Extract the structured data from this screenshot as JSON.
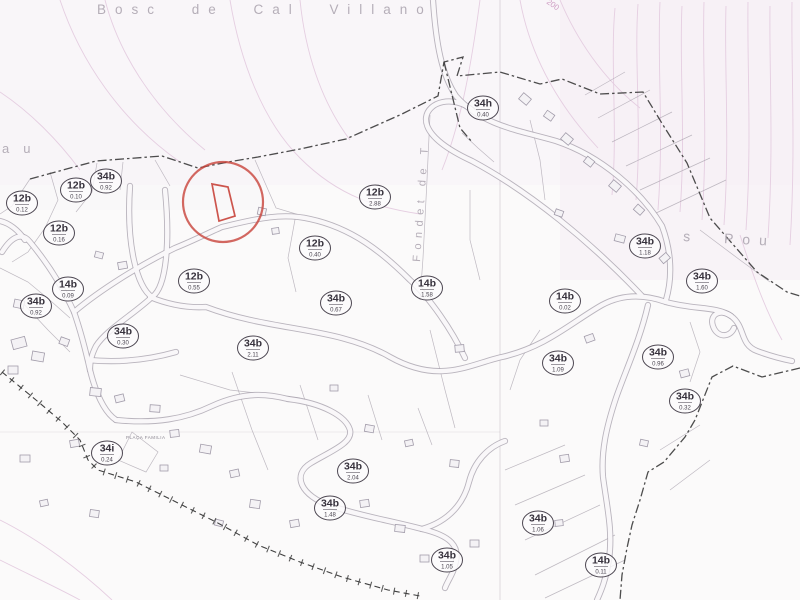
{
  "map": {
    "place_labels": {
      "top": "Bosc de Cal Villano",
      "left_edge": "au",
      "right_edge": "s  Pou",
      "street_vertical": "Fondet de T",
      "contour_elevation": "200",
      "plaza": "PLAÇA FAMILIA"
    },
    "colors": {
      "highlight_red": "#c8423a",
      "boundary_ink": "#3a3a3a",
      "parcel_line": "#a9a3ad",
      "contour_pink": "#e4cbdf",
      "label_ink": "#37323d",
      "paper": "#fbfafa"
    },
    "highlighted_parcel": {
      "x": 223,
      "y": 202,
      "radius": 40
    },
    "parcels": [
      {
        "code": "12b",
        "area": "0.12",
        "x": 22,
        "y": 203
      },
      {
        "code": "34b",
        "area": "0.92",
        "x": 106,
        "y": 181
      },
      {
        "code": "12b",
        "area": "0.10",
        "x": 76,
        "y": 190
      },
      {
        "code": "12b",
        "area": "0.16",
        "x": 59,
        "y": 233
      },
      {
        "code": "14b",
        "area": "0.09",
        "x": 68,
        "y": 289
      },
      {
        "code": "34b",
        "area": "0.92",
        "x": 36,
        "y": 306
      },
      {
        "code": "34b",
        "area": "0.30",
        "x": 123,
        "y": 336
      },
      {
        "code": "12b",
        "area": "0.55",
        "x": 194,
        "y": 281
      },
      {
        "code": "12b",
        "area": "2.88",
        "x": 375,
        "y": 197
      },
      {
        "code": "12b",
        "area": "0.40",
        "x": 315,
        "y": 248
      },
      {
        "code": "34h",
        "area": "0.40",
        "x": 483,
        "y": 108
      },
      {
        "code": "34b",
        "area": "0.67",
        "x": 336,
        "y": 303
      },
      {
        "code": "14b",
        "area": "1.58",
        "x": 427,
        "y": 288
      },
      {
        "code": "34b",
        "area": "2.11",
        "x": 253,
        "y": 348
      },
      {
        "code": "14b",
        "area": "0.02",
        "x": 565,
        "y": 301
      },
      {
        "code": "34b",
        "area": "1.18",
        "x": 645,
        "y": 246
      },
      {
        "code": "34b",
        "area": "1.60",
        "x": 702,
        "y": 281
      },
      {
        "code": "34b",
        "area": "1.09",
        "x": 558,
        "y": 363
      },
      {
        "code": "34b",
        "area": "0.96",
        "x": 658,
        "y": 357
      },
      {
        "code": "34b",
        "area": "0.32",
        "x": 685,
        "y": 401
      },
      {
        "code": "34i",
        "area": "0.24",
        "x": 107,
        "y": 453
      },
      {
        "code": "34b",
        "area": "2.04",
        "x": 353,
        "y": 471
      },
      {
        "code": "34b",
        "area": "1.48",
        "x": 330,
        "y": 508
      },
      {
        "code": "34b",
        "area": "1.06",
        "x": 538,
        "y": 523
      },
      {
        "code": "34b",
        "area": "1.05",
        "x": 447,
        "y": 560
      },
      {
        "code": "14b",
        "area": "0.11",
        "x": 601,
        "y": 565
      }
    ]
  }
}
